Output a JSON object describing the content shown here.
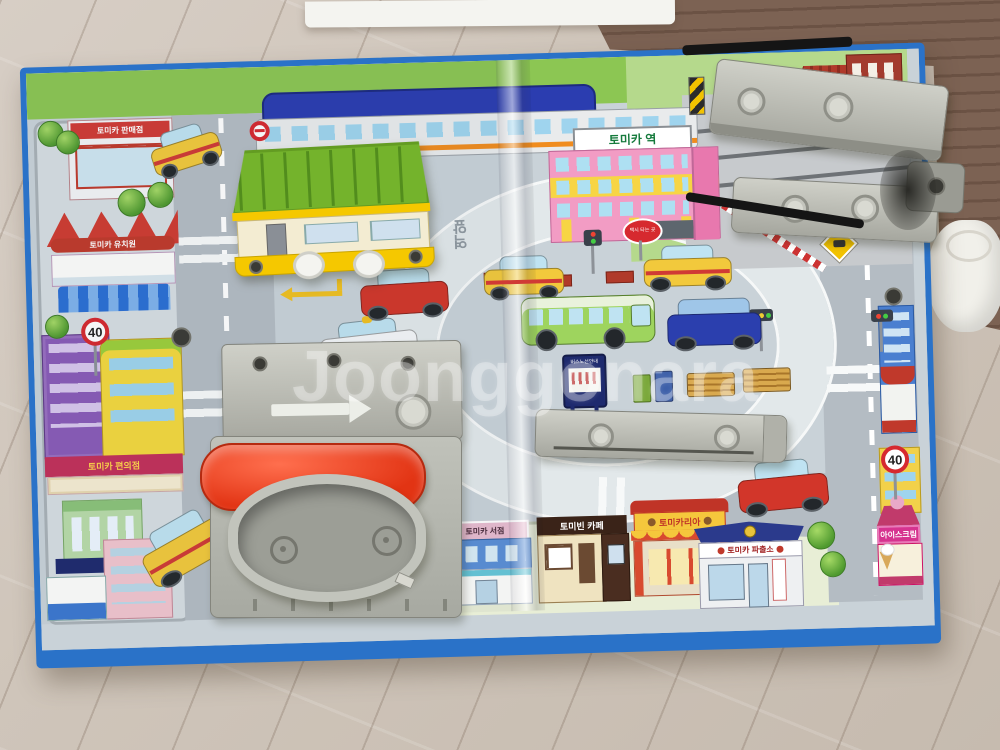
{
  "photo": {
    "watermark": "Joonggonara"
  },
  "labels": {
    "station_sign": "토미카 역",
    "store_sign": "토미카 판매점",
    "kindergarten_sign": "토미카 유치원",
    "convenience_sign": "토미카 편의점",
    "bookstore_sign": "토미카 서점",
    "cafe_sign": "토미빈 카페",
    "burger_sign": "토미카리아",
    "police_sign": "토미카 파출소",
    "icecream_sign": "아이스크림",
    "taxi_stand_sign": "택시 타는 곳",
    "bus_route_sign": "버스노선안내",
    "bus_stop_sign": "버스",
    "road_text": "역앞",
    "speed_limit": "40"
  },
  "colors": {
    "board_edge_blue": "#2a72c8",
    "toy_roof_green": "#74b32c",
    "toy_body_yellow": "#f5c800",
    "toy_lid_red": "#e8391d",
    "toy_plastic_gray": "#b9bab2",
    "bus_green": "#9ed45e",
    "taxi_yellow": "#f2c93c",
    "station_pink": "#f29cc4"
  }
}
